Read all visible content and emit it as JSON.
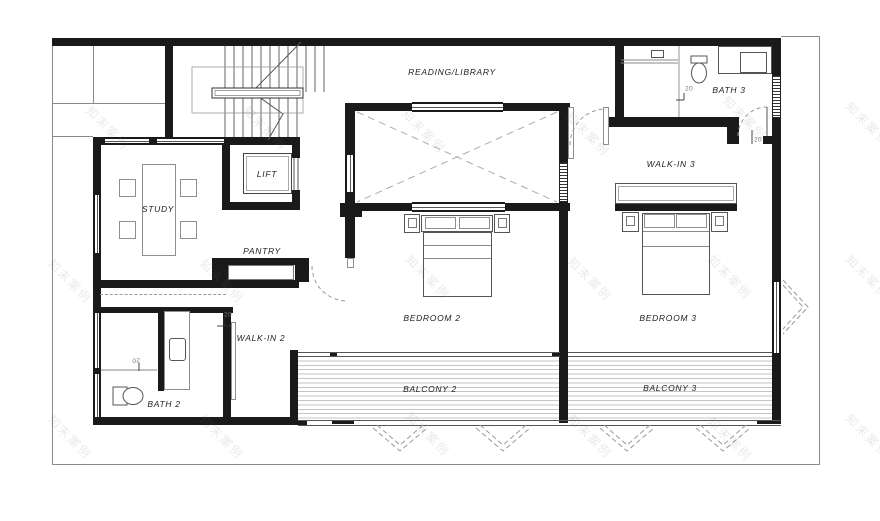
{
  "watermark": {
    "text": "知末案例"
  },
  "rooms": {
    "reading": "READING/LIBRARY",
    "bath3": "BATH 3",
    "walkin3": "WALK-IN 3",
    "study": "STUDY",
    "lift": "LIFT",
    "pantry": "PANTRY",
    "bedroom2": "BEDROOM 2",
    "bedroom3": "BEDROOM 3",
    "walkin2": "WALK-IN 2",
    "bath2": "BATH 2",
    "balcony2": "BALCONY 2",
    "balcony3": "BALCONY 3"
  },
  "tags": {
    "door": "20"
  }
}
